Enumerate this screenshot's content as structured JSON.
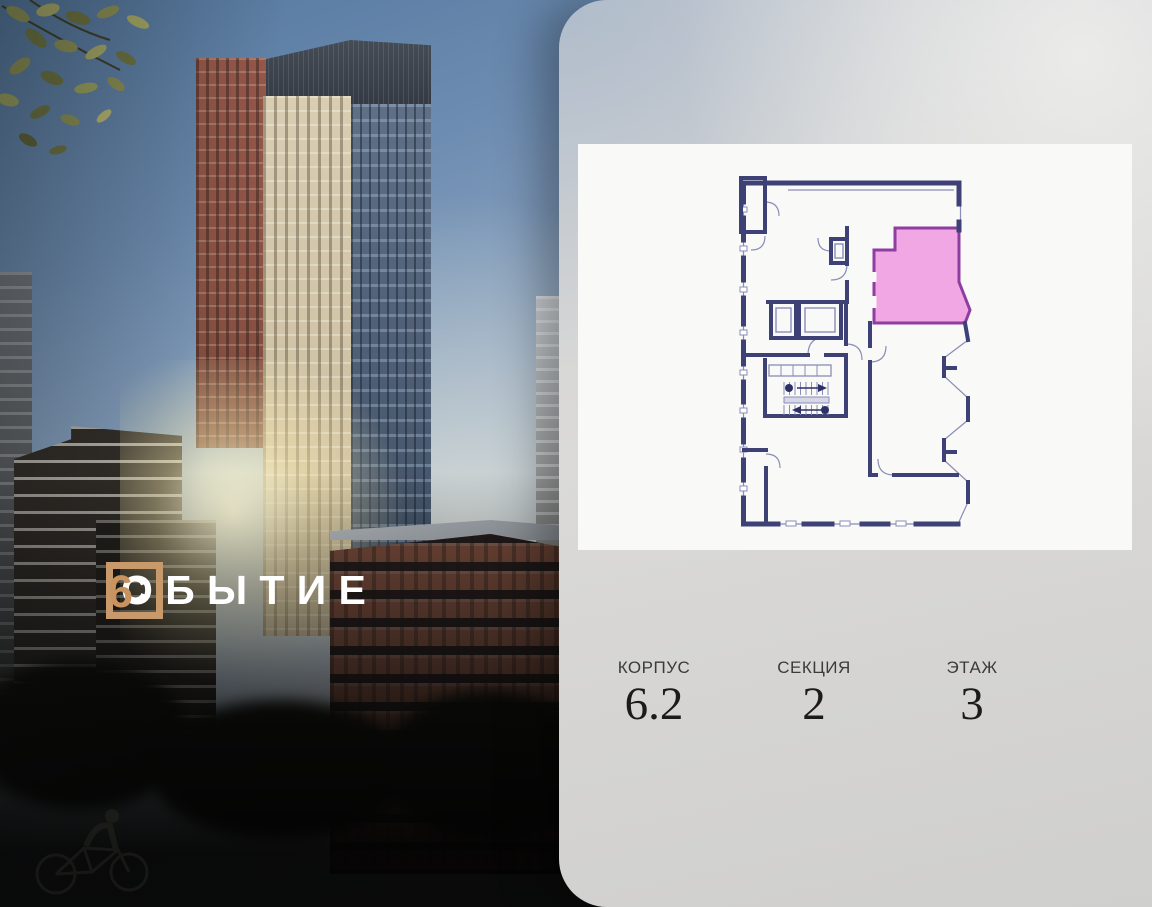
{
  "project": {
    "name": "СОБЫТИЕ 6",
    "logo": {
      "framed_letter": "С",
      "rest": "ОБЫТИЕ",
      "number": "6"
    },
    "logo_accent_color": "#c89a6b",
    "logo_number_color": "#c8935f"
  },
  "panel": {
    "plan": {
      "highlight_color": "#ef9fe2",
      "highlight_border": "#8f3da0",
      "wall_color": "#3e4175",
      "line_color": "#8a8db8"
    },
    "info": [
      {
        "label": "КОРПУС",
        "value": "6.2"
      },
      {
        "label": "СЕКЦИЯ",
        "value": "2"
      },
      {
        "label": "ЭТАЖ",
        "value": "3"
      }
    ]
  }
}
